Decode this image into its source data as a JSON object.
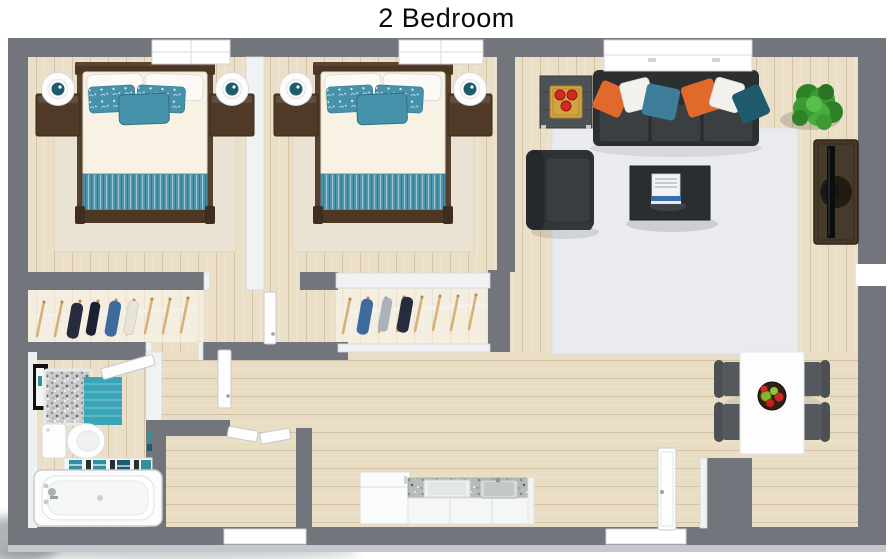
{
  "title": "2 Bedroom",
  "palette": {
    "wall": "#72767c",
    "wallLight": "#c4c7cb",
    "floor": "#ebdfc7",
    "windowWhite": "#ffffff",
    "interiorWall": "#f1f2f3",
    "teal": "#4792ab",
    "tealDeep": "#1e5b6c",
    "tealMat": "#3aa4b8",
    "orange": "#e0692b",
    "charcoal": "#34383b",
    "woodDark": "#4b3724",
    "rugBeige": "#eae3d3",
    "rugGray": "#eaebee",
    "plantGreen": "#3c9a33",
    "appleRed": "#d02a22",
    "trayGold": "#d2a440",
    "navy": "#262c3e",
    "denim": "#3d6b9e",
    "granite": "#b4b8b7",
    "chairGray": "#55595d",
    "tableWhite": "#fdfdfd"
  }
}
